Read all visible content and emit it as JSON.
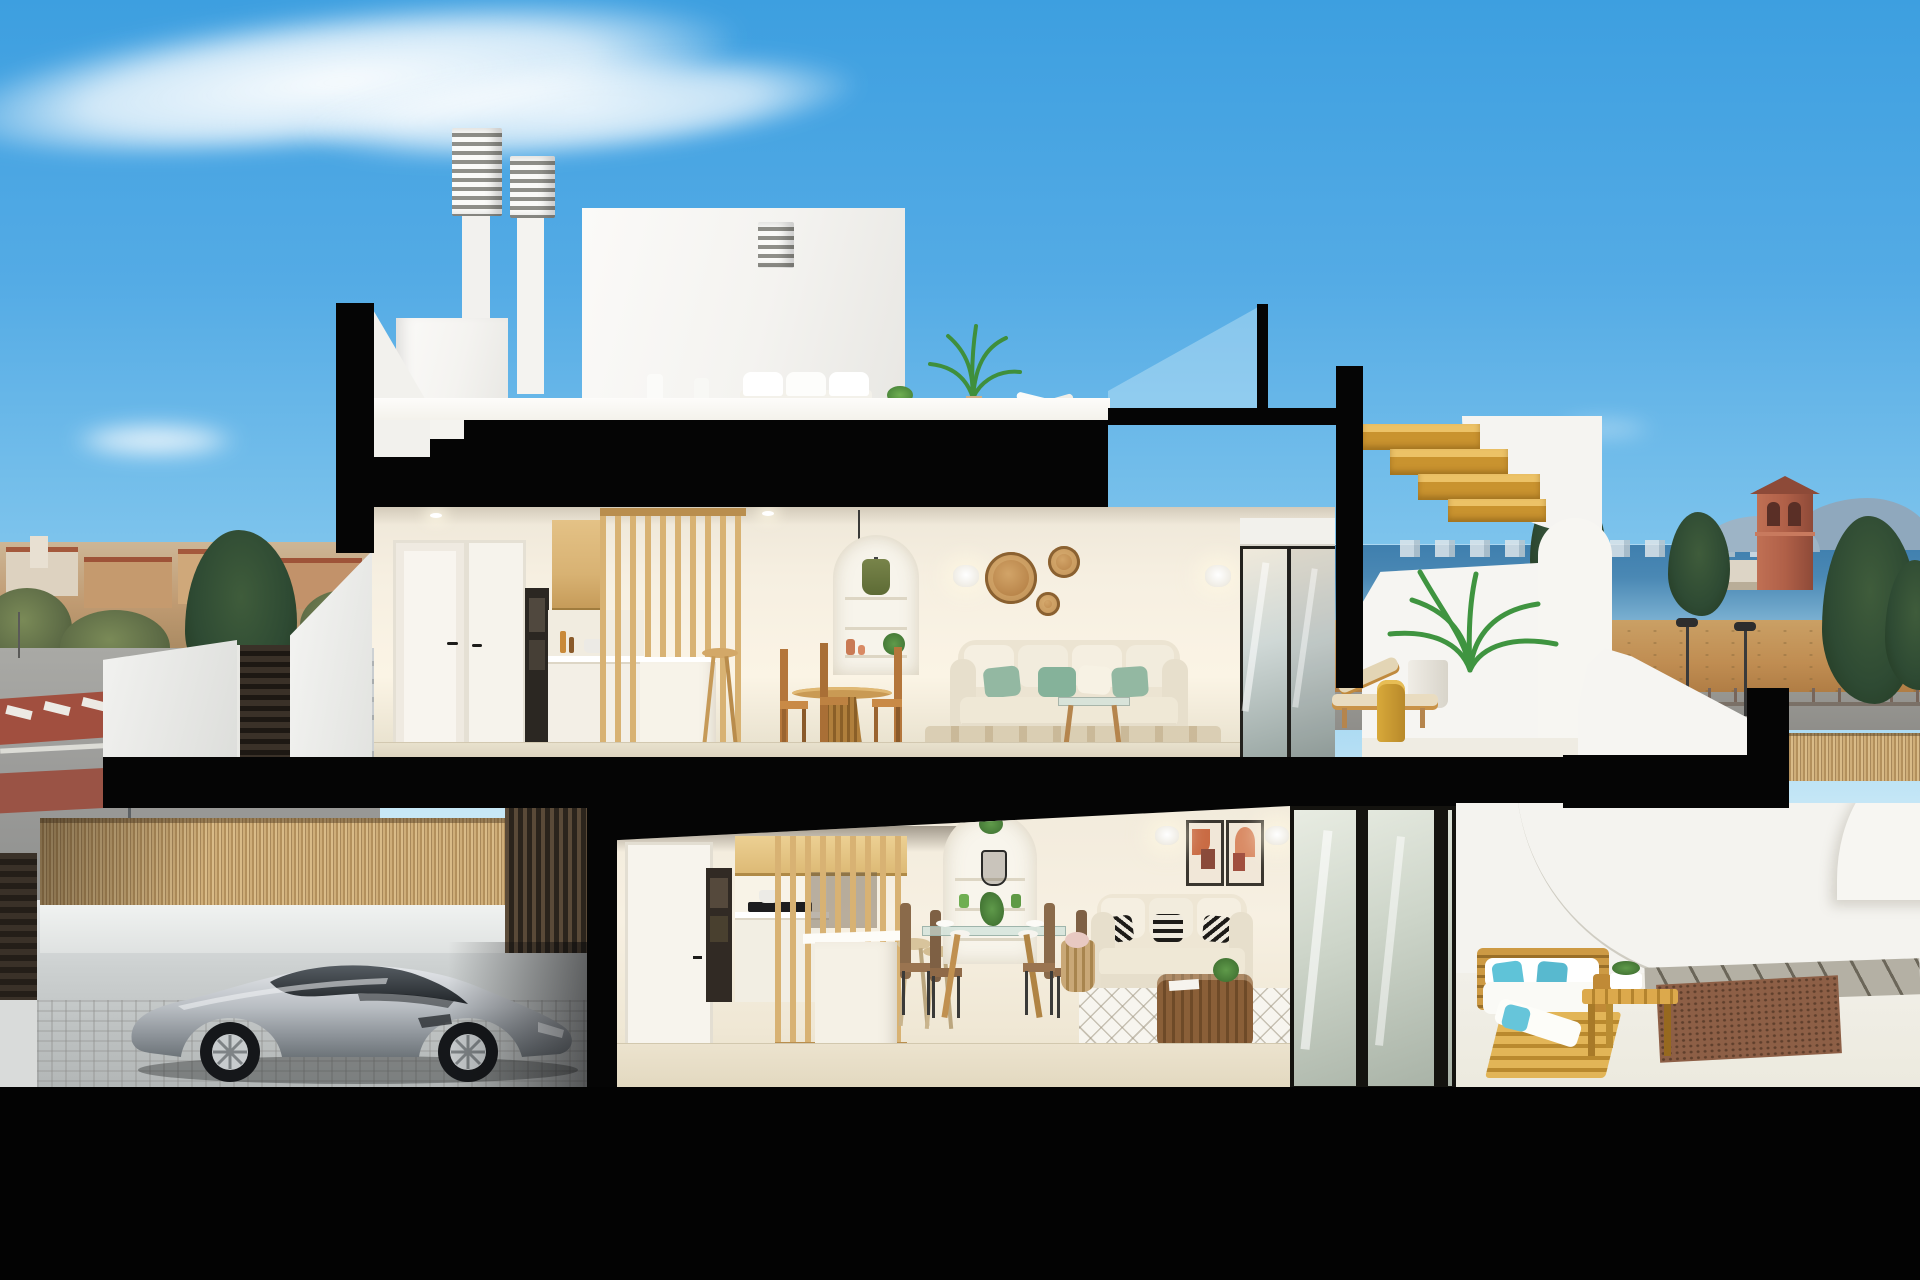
{
  "palette": {
    "sky_top": "#3d9fe0",
    "sky_horizon": "#c6e7f6",
    "cut_black": "#050505",
    "wall_white": "#f6f5f2",
    "interior_wall": "#f3ede1",
    "floor_tile": "#e9e1cf",
    "oak": "#d8b273",
    "oak_dark": "#b98e4e",
    "stair_wood": "#c9932f",
    "sofa_beige": "#ece4d2",
    "cushion_green": "#93b8a2",
    "cushion_teal": "#5fc3d8",
    "rattan_brown": "#b5854d",
    "car_silver": "#c2c6ca",
    "bamboo_tan": "#c5a671",
    "gate_dark": "#2e2620",
    "concrete_step": "#cdd1d3",
    "sea_blue": "#4a88b4",
    "field_tan": "#c08d52",
    "road_grey": "#9b9b99",
    "red_paving": "#a14f3f",
    "tower_terracotta": "#b06048",
    "tree_dark": "#2e4a33",
    "sign_blue": "#2277cc"
  },
  "scene": {
    "type": "3d-cutaway-cross-section-render-of-two-storey-villa",
    "sky": {
      "cloud_count": 4
    },
    "background_left": [
      "town-skyline-terracotta-roofs",
      "trees",
      "street",
      "red-paved-crosswalk",
      "round-blue-sign"
    ],
    "background_right": [
      "sea-with-city-skyline",
      "mountains",
      "watchtower",
      "white-building",
      "conifer-trees",
      "dry-field",
      "street-lamps",
      "boundary-bamboo-fence"
    ],
    "roof_level": [
      "louvered-chimney",
      "louvered-chimney",
      "louvered-chimney",
      "stair-bulkhead",
      "white-outdoor-lounge-set",
      "potted-plants",
      "tall-potted-palm",
      "ceiling-fan",
      "glass-railing",
      "cantilevered-wood-stairs"
    ],
    "upper_floor": [
      "entry-doors",
      "built-in-oven-column",
      "oak-upper-cabinets",
      "kitchen-counter",
      "oak-slat-partition",
      "kitchen-island",
      "bar-stool",
      "round-wood-dining-table",
      "wood-dining-chairs",
      "arched-shelf-niche-with-green-pendant",
      "wall-sconces",
      "rattan-wall-plates",
      "beige-sofa-with-green-pillows",
      "wood-glass-coffee-table",
      "striped-rug",
      "sliding-glass-door",
      "terrace-sun-lounger",
      "mustard-side-table",
      "potted-palm",
      "curved-white-parapet"
    ],
    "ground_floor": [
      "street-facing-bamboo-fence",
      "garage",
      "silver-sports-coupe",
      "dark-slat-garage-wall",
      "garage-door",
      "built-in-oven-column",
      "oak-upper-cabinets",
      "cooktop-counter",
      "oak-slat-partition",
      "white-island-bar",
      "wood-bar-stools",
      "arched-niche-with-wire-pendant",
      "glass-dining-table",
      "brown-dining-chairs",
      "beige-sofa-with-patterned-pillows",
      "rattan-coffee-table",
      "diamond-pattern-rug",
      "two-abstract-artworks",
      "wall-sconces",
      "storage-basket",
      "sliding-glass-door",
      "outdoor-wood-sofa-with-teal-pillows",
      "outdoor-wood-bench-table",
      "white-curved-terrace-walls",
      "gravel-bed",
      "paver-walkway"
    ],
    "section_cut": "matte-black-slabs-and-columns",
    "foreground": "solid-black-base-band"
  }
}
